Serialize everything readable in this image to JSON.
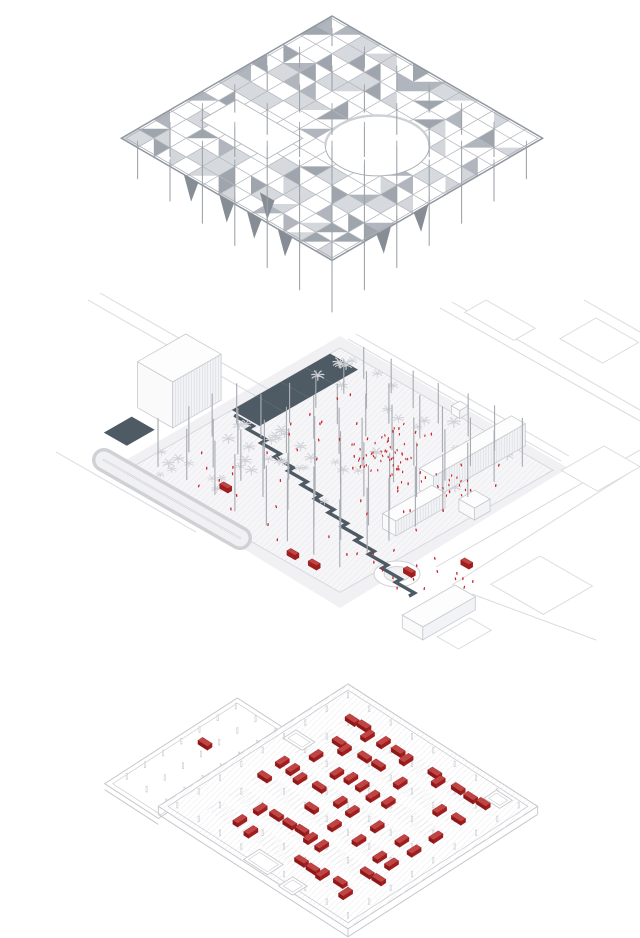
{
  "title": "Exploded axonometric architectural diagram: shade canopy, ground plaza, underground parking",
  "background": "#ffffff",
  "palette": {
    "canopy_light": "#cfd3d8",
    "canopy_mid": "#aab0b8",
    "canopy_dark": "#969da6",
    "canopy_line": "#b4b8be",
    "canopy_edge": "#9298a0",
    "fin": "#868d95",
    "column": "#9ba1a8",
    "plaza_column": "#a9adb3",
    "water": "#4e5a64",
    "water_line": "#6c757e",
    "ground": "#f6f6f8",
    "esplanade": "#f1f1f4",
    "ground_line": "#cfd1d5",
    "context_line": "#d9dadf",
    "building_fill": "#fdfdfe",
    "building_side": "#f2f3f6",
    "building_side2": "#fafafb",
    "building_stroke": "#c7c9ce",
    "stripe": "#dcdee2",
    "palm": "#d2d3d9",
    "person_red": "#c8242a",
    "car_red": "#a31d1d",
    "car_top": "#c14444",
    "car_stroke": "#8c1616",
    "parking_line": "#c6c8cc",
    "stall_line": "#e4e5e8",
    "peg": "#cbcdd1"
  },
  "canopy": {
    "origin": [
      332,
      16
    ],
    "cell": [
      16.2,
      9.4
    ],
    "grid": 13,
    "seed": 11,
    "circle_hole": {
      "x": 8.3,
      "y": 5.5,
      "r": 2.27
    },
    "rect_hole": {
      "x0": 1.5,
      "y0": 7.4,
      "x1": 5.6,
      "y1": 9.6
    },
    "column_nodes": [
      0.9,
      2.9,
      4.9,
      6.9,
      8.9,
      10.9,
      12.9
    ],
    "fins": [
      [
        4.3,
        12.7
      ],
      [
        6.5,
        12.7
      ],
      [
        8.2,
        12.7
      ],
      [
        10.1,
        12.7
      ],
      [
        12.7,
        7.5
      ],
      [
        12.7,
        9.8
      ],
      [
        7.6,
        11.6
      ]
    ]
  },
  "plaza": {
    "origin": [
      340,
      348
    ],
    "cell": [
      16.4,
      9.4
    ],
    "grid": 13,
    "esplanade": [
      [
        340,
        336
      ],
      [
        568,
        468
      ],
      [
        340,
        608
      ],
      [
        112,
        468
      ]
    ],
    "roads": [
      [
        [
          88,
          300
        ],
        [
          268,
          403
        ]
      ],
      [
        [
          100,
          293
        ],
        [
          280,
          396
        ]
      ],
      [
        [
          348,
          339
        ],
        [
          561,
          461
        ]
      ],
      [
        [
          356,
          334
        ],
        [
          569,
          456
        ]
      ],
      [
        [
          452,
          302
        ],
        [
          640,
          410
        ]
      ],
      [
        [
          440,
          308
        ],
        [
          640,
          421
        ]
      ],
      [
        [
          436,
          567
        ],
        [
          640,
          450
        ]
      ],
      [
        [
          452,
          585
        ],
        [
          640,
          466
        ]
      ],
      [
        [
          56,
          452
        ],
        [
          196,
          532
        ]
      ],
      [
        [
          472,
          594
        ],
        [
          596,
          640
        ]
      ],
      [
        [
          584,
          300
        ],
        [
          640,
          332
        ]
      ]
    ],
    "context_buildings": [
      {
        "a": [
          486,
          300
        ],
        "w": 3.0,
        "d": 1.3
      },
      {
        "a": [
          596,
          318
        ],
        "w": 2.6,
        "d": 2.2
      },
      {
        "a": [
          604,
          446
        ],
        "w": 2.2,
        "d": 2.6
      },
      {
        "a": [
          540,
          556
        ],
        "w": 3.2,
        "d": 3.0
      },
      {
        "a": [
          470,
          618
        ],
        "w": 1.3,
        "d": 2.0
      }
    ],
    "parking_loop": {
      "p1": [
        104,
        460
      ],
      "p2": [
        240,
        538
      ],
      "outer_w": 24,
      "inner_w": 17
    },
    "water": {
      "basin": {
        "x0": 0,
        "y0": 0.6,
        "x1": 1.7,
        "y1": 6.6
      },
      "patch": {
        "x0": -2.7,
        "y0": 10.0,
        "x1": -1.3,
        "y1": 11.7
      },
      "canal_start": [
        0.35,
        6.8
      ],
      "canal_steps": 13,
      "canal_dx": 1.15,
      "canal_dy": 0.33,
      "canal_width": 3.4
    },
    "buildings": [
      {
        "name": "hall",
        "x": -3.0,
        "y": 6.4,
        "w": 2.15,
        "d": 2.95,
        "h": 46,
        "stripes": true
      },
      {
        "name": "bar-ne",
        "x": 10.0,
        "y": -0.45,
        "w": 0.85,
        "d": 5.6,
        "h": 22,
        "stripes": true
      },
      {
        "name": "bar-e",
        "x": 10.9,
        "y": 5.3,
        "w": 0.8,
        "d": 3.0,
        "h": 15,
        "stripes": true
      },
      {
        "name": "kiosk",
        "x": 12.3,
        "y": 4.1,
        "w": 0.95,
        "d": 0.95,
        "h": 12,
        "stripes": false
      },
      {
        "name": "pavilion-n",
        "x": 6.9,
        "y": -0.4,
        "w": 0.5,
        "d": 0.5,
        "h": 8,
        "stripes": false
      },
      {
        "name": "bar-south",
        "x": 16.8,
        "y": 9.8,
        "w": 1.25,
        "d": 3.2,
        "h": 13,
        "stripes": false
      }
    ],
    "roundabout": {
      "cx": 397,
      "cy": 574,
      "rx": 23,
      "ry": 13,
      "irx": 13,
      "iry": 7.5
    },
    "palm_seed": 5,
    "palm_regions": [
      {
        "x0": 0.2,
        "x1": 4.6,
        "y0": 6.4,
        "y1": 12.4,
        "n": 26
      },
      {
        "x0": 0.5,
        "x1": 6.0,
        "y0": 0.3,
        "y1": 3.0,
        "n": 10
      },
      {
        "x0": 6.5,
        "x1": 11.5,
        "y0": 0.2,
        "y1": 2.4,
        "n": 8
      },
      {
        "x0": 10.0,
        "x1": 12.6,
        "y0": 4.0,
        "y1": 8.0,
        "n": 6
      },
      {
        "x0": 4.0,
        "x1": 9.0,
        "y0": 3.0,
        "y1": 9.0,
        "n": 8
      }
    ],
    "columns": {
      "start": 0.9,
      "step": 1.55,
      "count": 8,
      "seed": 21
    },
    "crowd": {
      "seed": 9,
      "clusters": [
        {
          "x": 7.2,
          "y": 4.2,
          "n": 55,
          "sd": 0.85
        },
        {
          "x": 11.05,
          "y": 4.05,
          "n": 12,
          "sd": 0.5
        }
      ],
      "singles": {
        "n": 58,
        "x0": 1.2,
        "x1": 12.6,
        "y0": 0.8,
        "y1": 12.2
      },
      "promenade": {
        "n": 14,
        "x0": 13.0,
        "x1": 16.6,
        "y0": 8.0,
        "y1": 11.6
      }
    },
    "cars": [
      [
        3.8,
        10.9
      ],
      [
        9.4,
        12.4
      ],
      [
        10.6,
        12.3
      ],
      [
        13.9,
        9.8
      ],
      [
        15.2,
        7.6
      ]
    ]
  },
  "parking": {
    "origin": [
      348,
      684
    ],
    "cell": [
      15.8,
      10.2
    ],
    "grid": 12,
    "seed": 13,
    "wing": {
      "x0": -3.4,
      "x1": 0,
      "y0": 3.6,
      "y1": 12,
      "dz": 12
    },
    "rows": [
      1.8,
      3.2,
      4.6,
      6.0,
      7.4,
      8.8,
      10.2
    ],
    "row_x0": 1.7,
    "row_x1": 10.5,
    "slot": 0.65,
    "car_prob": 0.62,
    "columns_step": 1.35,
    "stalls": {
      "tick": 0.45,
      "step": 0.27
    },
    "features": [
      {
        "x": 5.3,
        "y": 10.9,
        "w": 1.5,
        "d": 1.0
      },
      {
        "x": 9.9,
        "y": 0.5,
        "w": 1.0,
        "d": 0.8
      },
      {
        "x": 0.6,
        "y": 3.9,
        "w": 1.2,
        "d": 0.8
      },
      {
        "x": 7.7,
        "y": 11.2,
        "w": 0.9,
        "d": 0.9
      }
    ],
    "wing_car": [
      -1.8,
      7.4
    ]
  }
}
